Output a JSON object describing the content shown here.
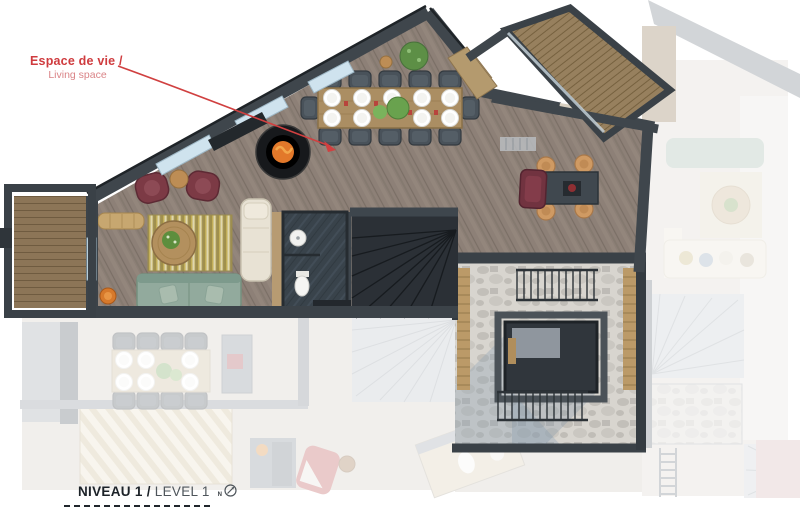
{
  "annotation": {
    "title": "Espace de vie /",
    "subtitle": "Living space"
  },
  "level_label": {
    "name_fr": "NIVEAU 1 /",
    "name_en": "LEVEL 1",
    "north_letter": "N"
  },
  "plan": {
    "type": "architectural-floor-plan",
    "level": "Niveau 1 / Level 1",
    "rooms_visible": [
      "living-space",
      "dining-area",
      "bathroom",
      "staircase",
      "games-corner",
      "terrace",
      "left-balcony",
      "top-balcony"
    ],
    "furniture_visible": [
      "dining-table-10-plates",
      "suspended-fireplace",
      "two-maroon-armchairs",
      "side-table",
      "rattan-bench",
      "yellow-rug",
      "round-coffee-table",
      "green-sofa",
      "beige-chaise",
      "orange-stool",
      "games-table",
      "four-stools",
      "maroon-armchair",
      "sink",
      "toilet"
    ]
  },
  "colors": {
    "annotation_red": "#cf3b3e",
    "annotation_red_light": "#da8487",
    "label_dark": "#1c2228",
    "label_grey": "#4e555b",
    "wall_dark": "#3d444a",
    "wood_floor": "#8d8077",
    "deck_wood": "#8c7557",
    "rug_yellow": "#c5b157",
    "sofa_green": "#92aa9d",
    "chaise_beige": "#e8e2d4",
    "armchair_maroon": "#7c3a45",
    "stool_tan": "#cf9a63",
    "fire_orange": "#e2782a",
    "slate_dark": "#39434b",
    "stone_light": "#d8d5cf",
    "window_glass": "#cfe3ee"
  }
}
